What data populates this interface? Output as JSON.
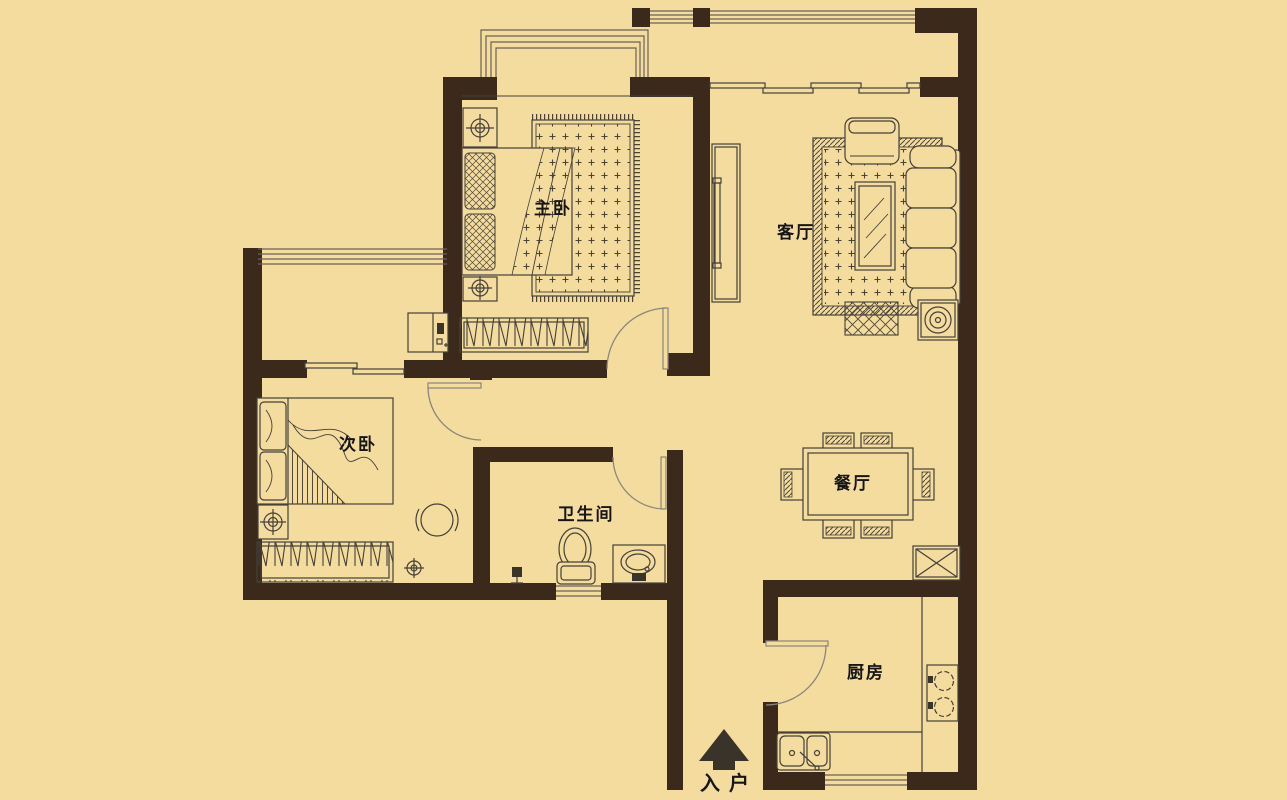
{
  "meta": {
    "type": "apartment-floor-plan",
    "language": "zh-CN"
  },
  "colors": {
    "background": "#F4DB9E",
    "wall": "#3B2A1B",
    "furniture_line": "#44403A",
    "door_arc": "#8B867E",
    "label_text": "#161616",
    "entry_arrow": "#3A332A"
  },
  "rooms": {
    "master_bedroom": {
      "label": "主卧"
    },
    "living_room": {
      "label": "客厅"
    },
    "second_bedroom": {
      "label": "次卧"
    },
    "bathroom": {
      "label": "卫生间"
    },
    "dining_room": {
      "label": "餐厅"
    },
    "kitchen": {
      "label": "厨房"
    }
  },
  "entrance": {
    "label": "入户",
    "icon": "arrow-up-icon"
  }
}
